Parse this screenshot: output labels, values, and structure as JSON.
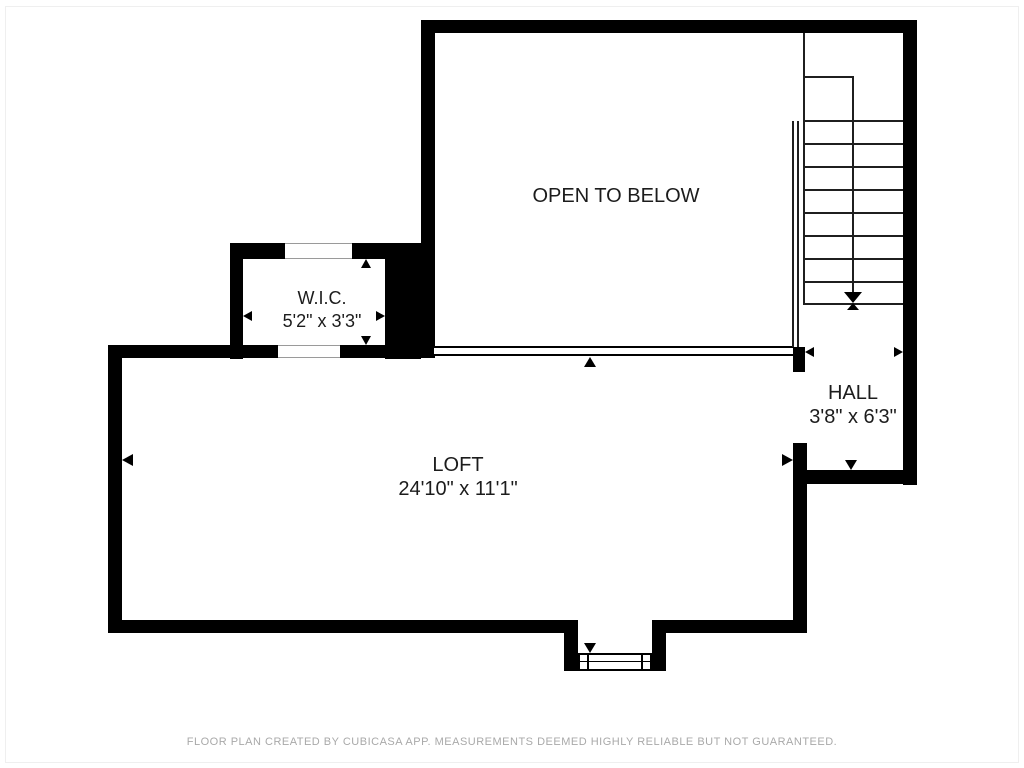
{
  "plan": {
    "rooms": {
      "open_to_below": {
        "label": "OPEN TO BELOW"
      },
      "wic": {
        "label": "W.I.C.",
        "dimensions": "5'2\" x 3'3\""
      },
      "loft": {
        "label": "LOFT",
        "dimensions": "24'10\" x 11'1\""
      },
      "hall": {
        "label": "HALL",
        "dimensions": "3'8\" x 6'3\""
      }
    },
    "stairs": {
      "tread_count": 9,
      "direction": "down-into-hall"
    },
    "colors": {
      "wall": "#000000",
      "label_text": "#1c1c1c",
      "footer_text": "#a9a9a9",
      "background": "#ffffff"
    },
    "footer": "FLOOR PLAN CREATED BY CUBICASA APP. MEASUREMENTS DEEMED HIGHLY RELIABLE BUT NOT GUARANTEED."
  }
}
